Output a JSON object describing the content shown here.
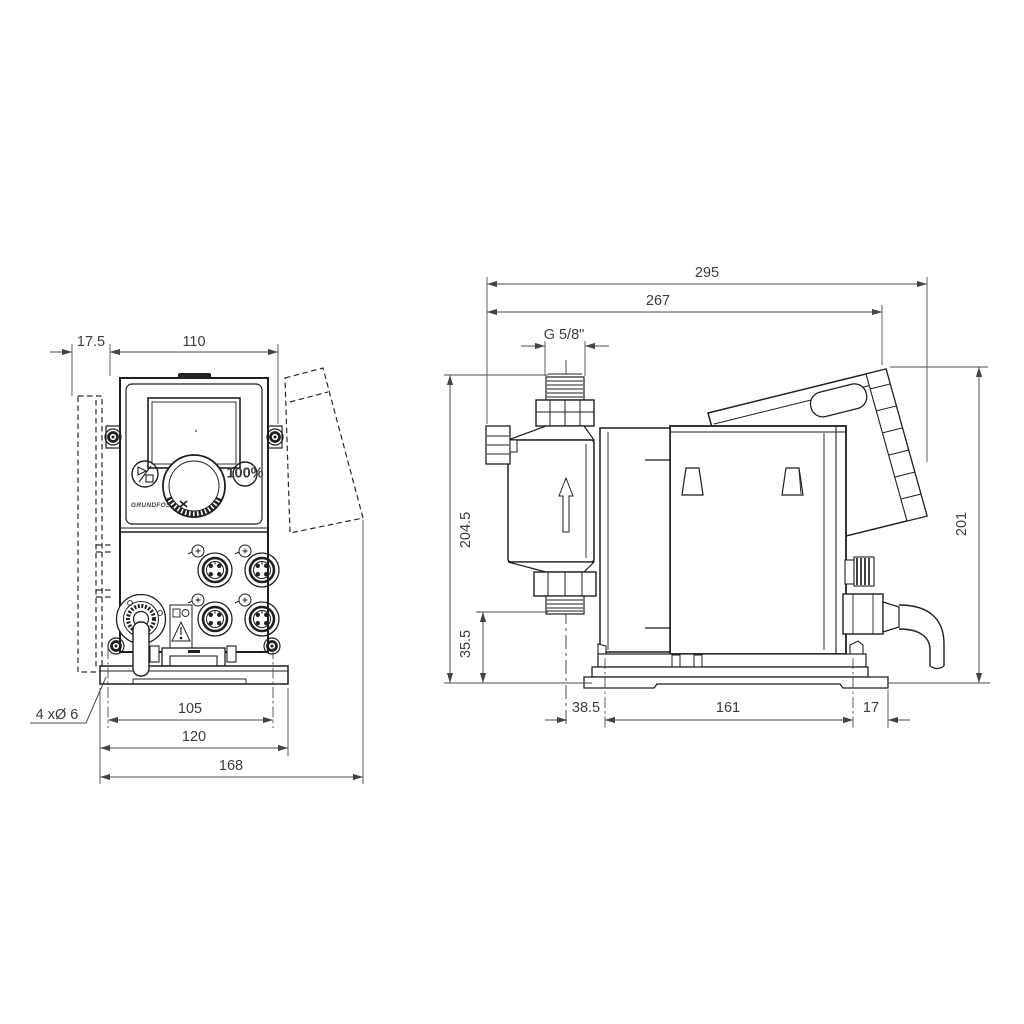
{
  "front_view": {
    "dimensions": {
      "plate_offset": "17.5",
      "control_width": "110",
      "hole_spacing": "105",
      "bracket_width": "120",
      "overall_width": "168",
      "mounting_holes": "4 xØ 6"
    },
    "panel": {
      "brand": "GRUNDFOS",
      "boost_button": "100%"
    }
  },
  "side_view": {
    "dimensions": {
      "overall_depth": "295",
      "body_depth": "267",
      "thread": "G 5/8\"",
      "overall_height": "204.5",
      "inlet_height": "35.5",
      "head_offset": "38.5",
      "hole_spacing": "161",
      "rear_offset": "17",
      "housing_height": "201"
    }
  }
}
